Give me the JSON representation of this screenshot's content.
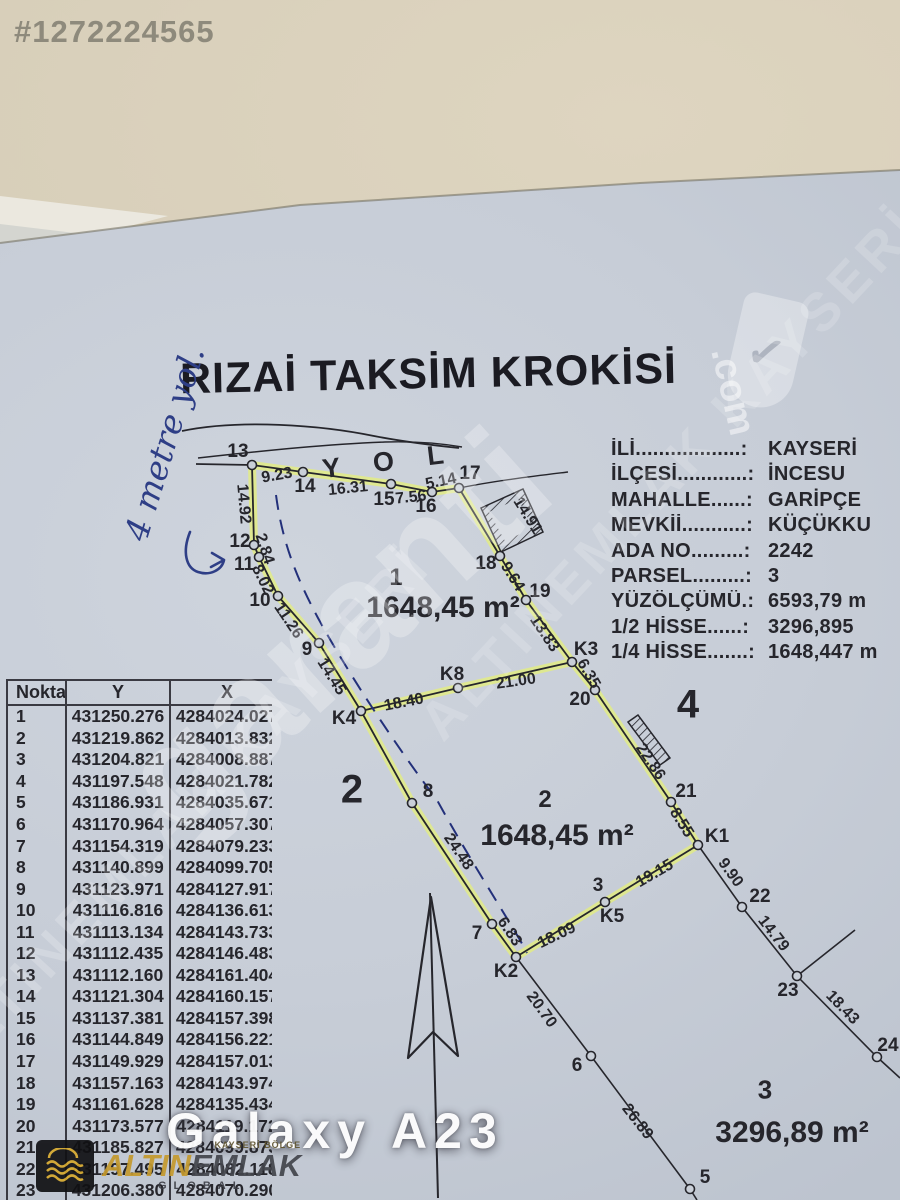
{
  "listing_id": "#1272224565",
  "handwritten_note": "4 metre yol.",
  "title": "RIZAİ TAKSİM KROKİSİ",
  "info_rows": [
    {
      "label": "İLİ..................:",
      "value": "KAYSERİ"
    },
    {
      "label": "İLÇESİ............:",
      "value": "İNCESU"
    },
    {
      "label": "MAHALLE......:",
      "value": "GARİPÇE"
    },
    {
      "label": "MEVKİİ...........:",
      "value": "KÜÇÜKKU"
    },
    {
      "label": "ADA NO.........:",
      "value": "2242"
    },
    {
      "label": "PARSEL.........:",
      "value": "3"
    },
    {
      "label": "YÜZÖLÇÜMÜ.:",
      "value": "6593,79 m"
    },
    {
      "label": "1/2 HİSSE......:",
      "value": "3296,895"
    },
    {
      "label": "1/4 HİSSE.......:",
      "value": "1648,447 m"
    }
  ],
  "coordinate_table": {
    "headers": [
      "Nokta",
      "Y",
      "X"
    ],
    "rows": [
      [
        "1",
        "431250.276",
        "4284024.027"
      ],
      [
        "2",
        "431219.862",
        "4284013.832"
      ],
      [
        "3",
        "431204.821",
        "4284008.887"
      ],
      [
        "4",
        "431197.548",
        "4284021.782"
      ],
      [
        "5",
        "431186.931",
        "4284035.671"
      ],
      [
        "6",
        "431170.964",
        "4284057.307"
      ],
      [
        "7",
        "431154.319",
        "4284079.233"
      ],
      [
        "8",
        "431140.899",
        "4284099.705"
      ],
      [
        "9",
        "431123.971",
        "4284127.917"
      ],
      [
        "10",
        "431116.816",
        "4284136.613"
      ],
      [
        "11",
        "431113.134",
        "4284143.733"
      ],
      [
        "12",
        "431112.435",
        "4284146.483"
      ],
      [
        "13",
        "431112.160",
        "4284161.404"
      ],
      [
        "14",
        "431121.304",
        "4284160.157"
      ],
      [
        "15",
        "431137.381",
        "4284157.398"
      ],
      [
        "16",
        "431144.849",
        "4284156.221"
      ],
      [
        "17",
        "431149.929",
        "4284157.013"
      ],
      [
        "18",
        "431157.163",
        "4284143.974"
      ],
      [
        "19",
        "431161.628",
        "4284135.434"
      ],
      [
        "20",
        "431173.577",
        "4284119.172"
      ],
      [
        "21",
        "431185.827",
        "4284099.873"
      ],
      [
        "22",
        "431197.495",
        "4284082.118"
      ],
      [
        "23",
        "431206.380",
        "4284070.290"
      ]
    ]
  },
  "sketch": {
    "road_label": "Y O L",
    "point_labels": [
      {
        "text": "13",
        "x": 238,
        "y": 452
      },
      {
        "text": "14",
        "x": 305,
        "y": 487
      },
      {
        "text": "15",
        "x": 384,
        "y": 500
      },
      {
        "text": "16",
        "x": 426,
        "y": 507
      },
      {
        "text": "17",
        "x": 470,
        "y": 474
      },
      {
        "text": "18",
        "x": 486,
        "y": 564
      },
      {
        "text": "19",
        "x": 540,
        "y": 592
      },
      {
        "text": "K3",
        "x": 586,
        "y": 650
      },
      {
        "text": "20",
        "x": 580,
        "y": 700
      },
      {
        "text": "21",
        "x": 686,
        "y": 792
      },
      {
        "text": "K1",
        "x": 717,
        "y": 837
      },
      {
        "text": "22",
        "x": 760,
        "y": 897
      },
      {
        "text": "23",
        "x": 788,
        "y": 991
      },
      {
        "text": "24",
        "x": 888,
        "y": 1046
      },
      {
        "text": "K8",
        "x": 452,
        "y": 675
      },
      {
        "text": "K4",
        "x": 344,
        "y": 719
      },
      {
        "text": "K2",
        "x": 506,
        "y": 972
      },
      {
        "text": "K5",
        "x": 612,
        "y": 917
      },
      {
        "text": "9",
        "x": 307,
        "y": 650
      },
      {
        "text": "8",
        "x": 428,
        "y": 792
      },
      {
        "text": "7",
        "x": 477,
        "y": 934
      },
      {
        "text": "12",
        "x": 240,
        "y": 542
      },
      {
        "text": "11",
        "x": 244,
        "y": 565
      },
      {
        "text": "10",
        "x": 260,
        "y": 601
      },
      {
        "text": "6",
        "x": 577,
        "y": 1066
      },
      {
        "text": "5",
        "x": 705,
        "y": 1178
      },
      {
        "text": "3",
        "x": 598,
        "y": 886
      }
    ],
    "measurements": [
      {
        "text": "9.23",
        "x": 277,
        "y": 476,
        "rot": -10
      },
      {
        "text": "16.31",
        "x": 348,
        "y": 489,
        "rot": -6
      },
      {
        "text": "7.56",
        "x": 411,
        "y": 498,
        "rot": -6
      },
      {
        "text": "5.14",
        "x": 441,
        "y": 482,
        "rot": -12
      },
      {
        "text": "14.92",
        "x": 243,
        "y": 504,
        "rot": 85
      },
      {
        "text": "2.84",
        "x": 264,
        "y": 549,
        "rot": 72
      },
      {
        "text": "8.02",
        "x": 262,
        "y": 580,
        "rot": 64
      },
      {
        "text": "11.26",
        "x": 288,
        "y": 621,
        "rot": 56
      },
      {
        "text": "14.45",
        "x": 331,
        "y": 677,
        "rot": 58
      },
      {
        "text": "24.48",
        "x": 458,
        "y": 852,
        "rot": 56
      },
      {
        "text": "6.83",
        "x": 509,
        "y": 932,
        "rot": 56
      },
      {
        "text": "14.91",
        "x": 527,
        "y": 516,
        "rot": 58
      },
      {
        "text": "9.64",
        "x": 512,
        "y": 577,
        "rot": 58
      },
      {
        "text": "13.83",
        "x": 544,
        "y": 634,
        "rot": 56
      },
      {
        "text": "6.35",
        "x": 588,
        "y": 674,
        "rot": 60
      },
      {
        "text": "22.86",
        "x": 650,
        "y": 762,
        "rot": 56
      },
      {
        "text": "8.55",
        "x": 681,
        "y": 823,
        "rot": 58
      },
      {
        "text": "9.90",
        "x": 730,
        "y": 873,
        "rot": 54
      },
      {
        "text": "14.79",
        "x": 773,
        "y": 934,
        "rot": 52
      },
      {
        "text": "18.43",
        "x": 842,
        "y": 1008,
        "rot": 46
      },
      {
        "text": "20.70",
        "x": 541,
        "y": 1010,
        "rot": 54
      },
      {
        "text": "26.89",
        "x": 637,
        "y": 1122,
        "rot": 52
      },
      {
        "text": "21.00",
        "x": 516,
        "y": 682,
        "rot": -8
      },
      {
        "text": "18.40",
        "x": 404,
        "y": 703,
        "rot": -11
      },
      {
        "text": "18.09",
        "x": 557,
        "y": 936,
        "rot": -26
      },
      {
        "text": "19.15",
        "x": 655,
        "y": 874,
        "rot": -30
      }
    ],
    "parcel_labels": [
      {
        "text": "1",
        "x": 396,
        "y": 578,
        "size": 24
      },
      {
        "text": "1648,45 m²",
        "x": 443,
        "y": 608,
        "size": 30
      },
      {
        "text": "2",
        "x": 545,
        "y": 800,
        "size": 24
      },
      {
        "text": "1648,45 m²",
        "x": 557,
        "y": 836,
        "size": 30
      },
      {
        "text": "3",
        "x": 765,
        "y": 1090,
        "size": 26
      },
      {
        "text": "3296,89 m²",
        "x": 792,
        "y": 1133,
        "size": 30
      },
      {
        "text": "2",
        "x": 352,
        "y": 790,
        "size": 40
      },
      {
        "text": "4",
        "x": 688,
        "y": 705,
        "size": 40
      }
    ]
  },
  "watermarks": {
    "brand": "garanti",
    "brand_suffix": ".com",
    "shield_check": "✓",
    "ghost_text": "ALTINEMLAK KAYSERİ",
    "device": "Galaxy A23",
    "agency_region": "KAYSERİ BÖLGE",
    "agency_name_gold": "ALTIN",
    "agency_name_dark": "EMLAK",
    "agency_sub": "GLOBAL"
  }
}
